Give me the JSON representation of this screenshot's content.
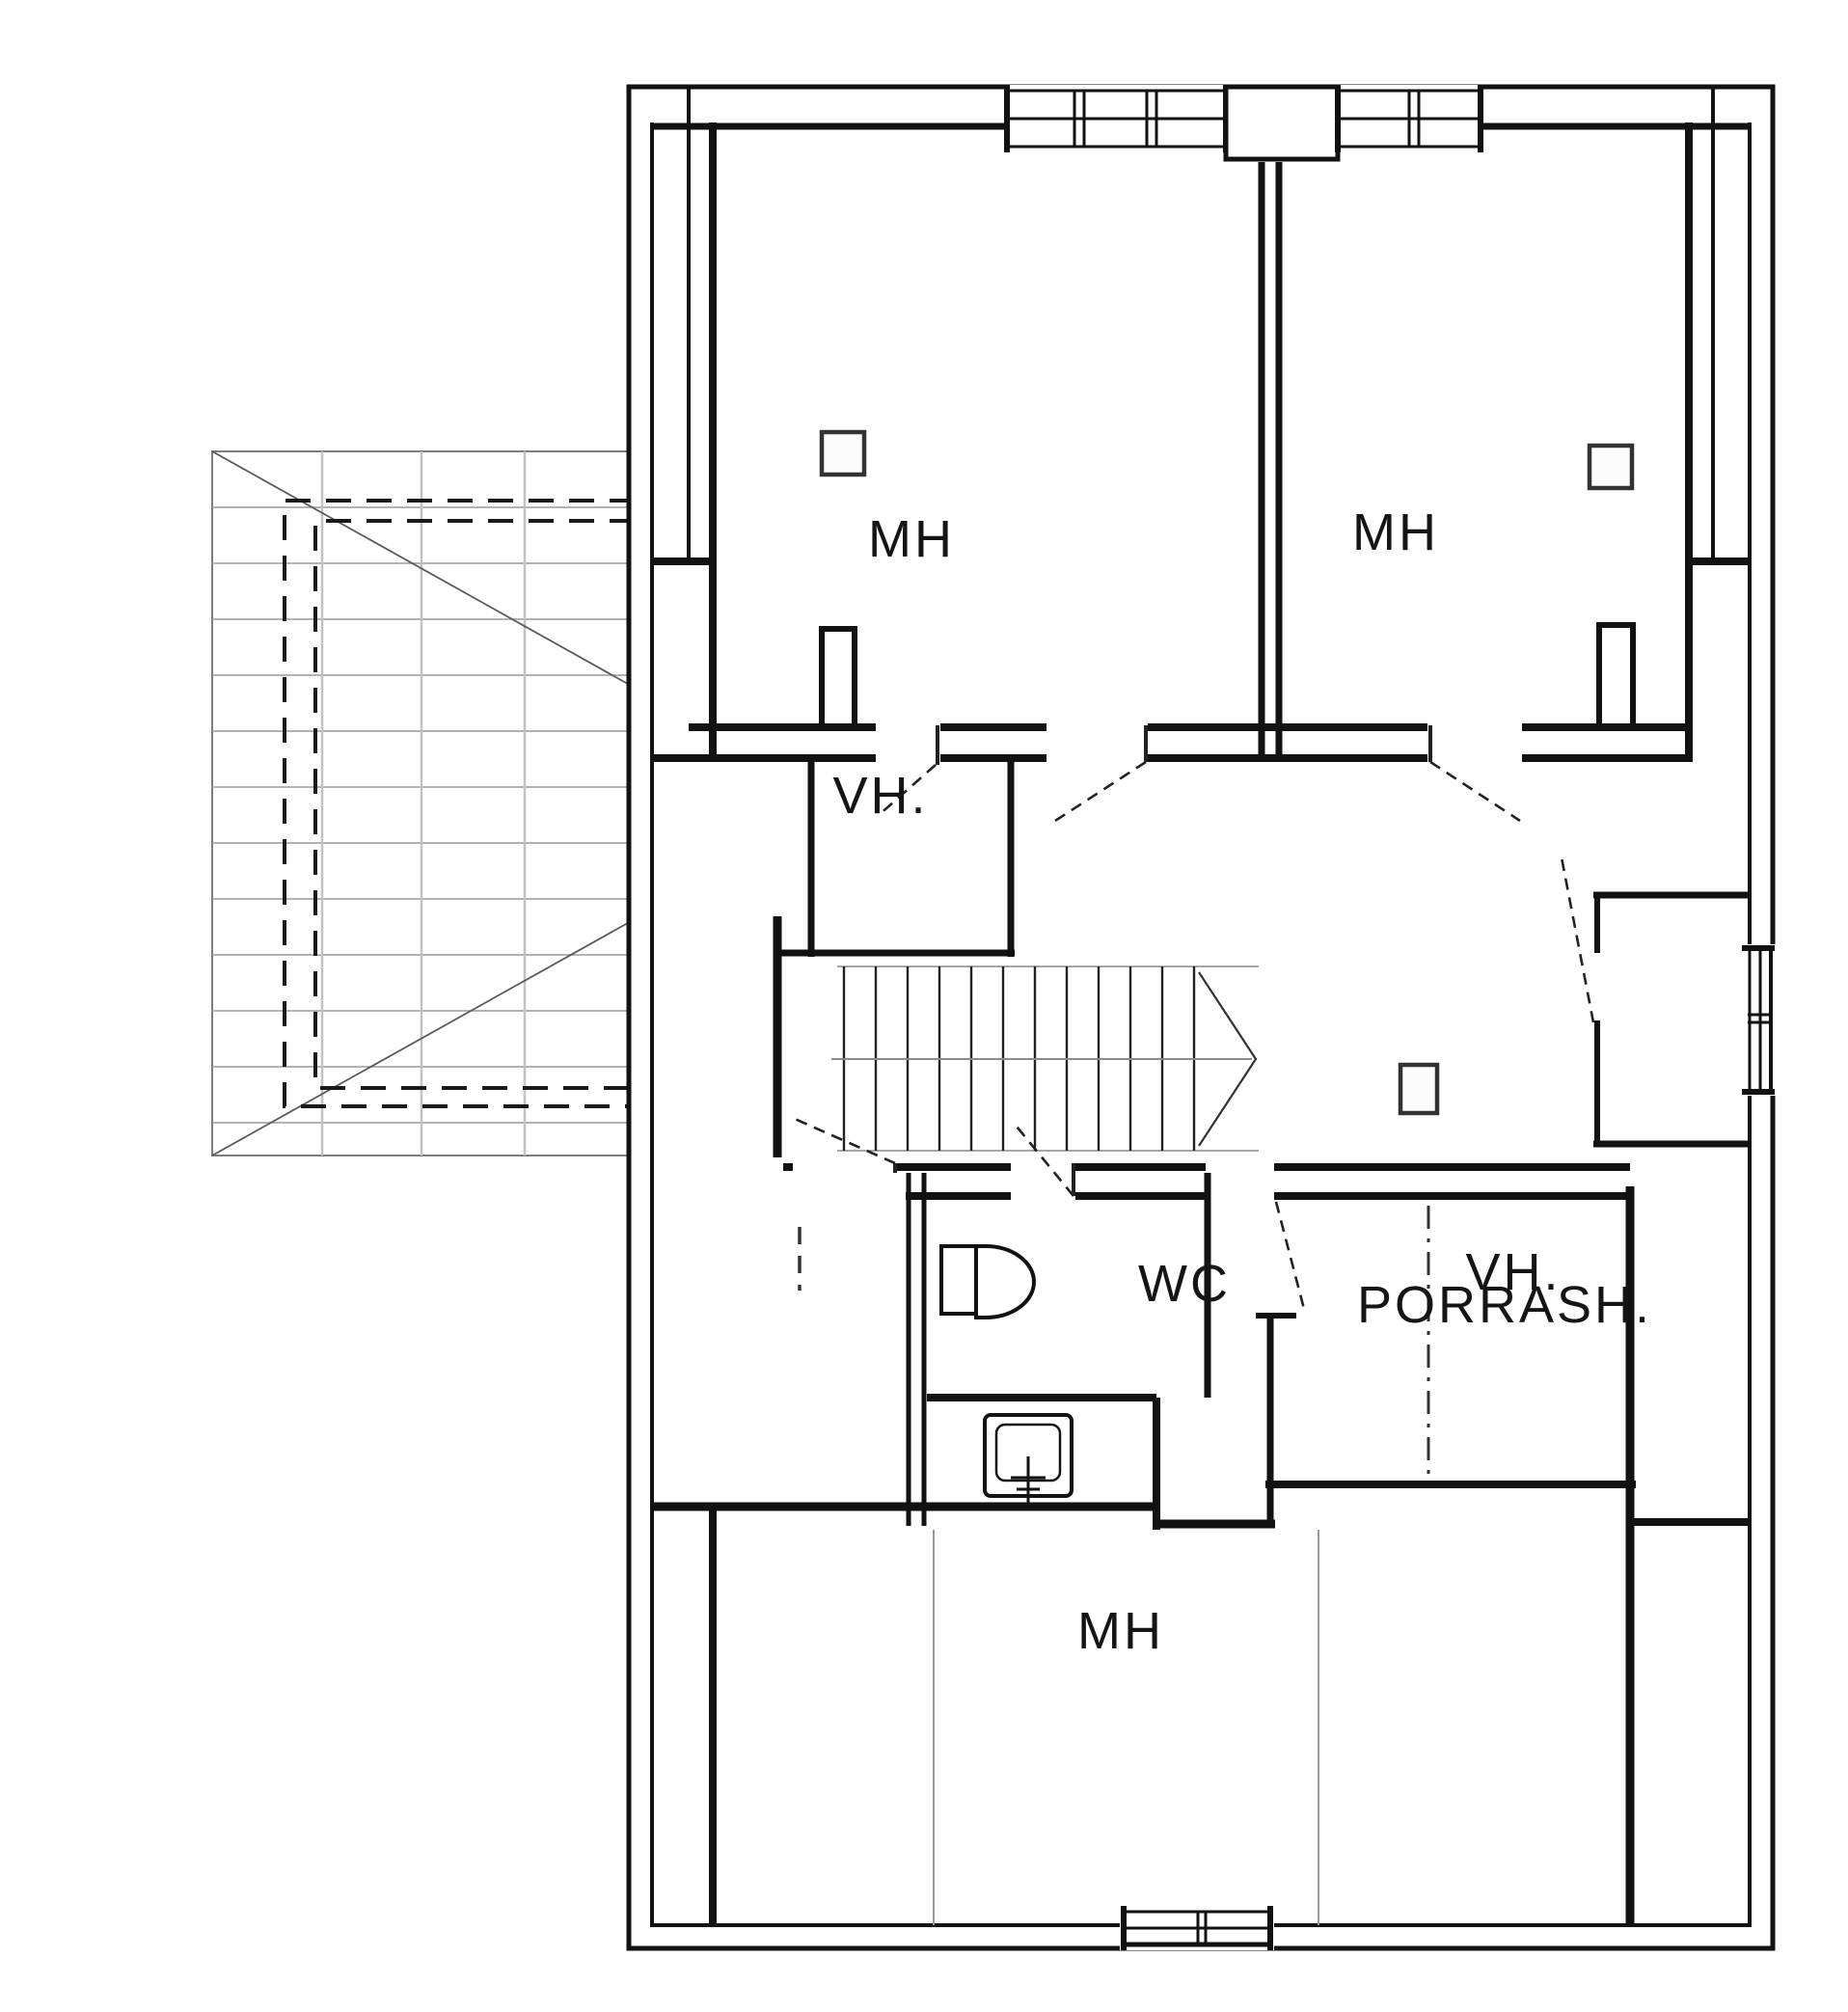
{
  "colors": {
    "wall": "#121212",
    "roof_line": "#9a9a9a",
    "roof_outline": "#7d7d7d",
    "roof_diagonal": "#5a5a5a",
    "thin_line": "#999999",
    "background": "#ffffff"
  },
  "rooms": {
    "mh_top_left": {
      "label": "MH"
    },
    "mh_top_right": {
      "label": "MH"
    },
    "vh_top": {
      "label": "VH."
    },
    "porrash": {
      "label": "PORRASH."
    },
    "wc": {
      "label": "WC"
    },
    "vh_bottom": {
      "label": "VH."
    },
    "mh_bottom": {
      "label": "MH"
    }
  }
}
